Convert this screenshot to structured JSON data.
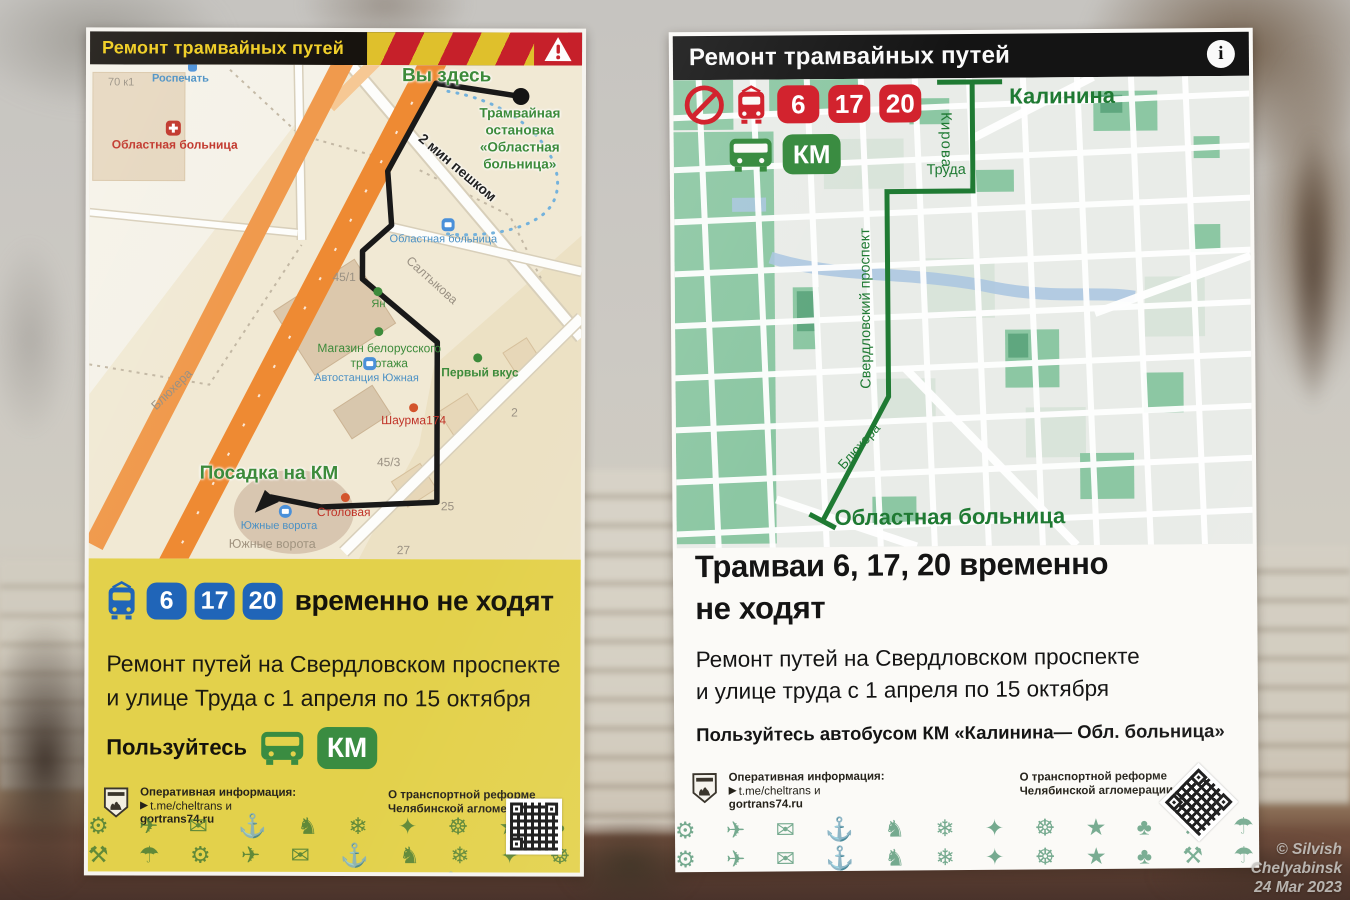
{
  "left_poster": {
    "header_title": "Ремонт трамвайных путей",
    "map": {
      "bld_70k1": "70 к1",
      "rospechat": "Роспечать",
      "hospital_poi": "Областная больница",
      "you_are_here": "Вы здесь",
      "tram_stop_l1": "Трамвайная",
      "tram_stop_l2": "остановка",
      "tram_stop_l3": "«Областная",
      "tram_stop_l4": "больница»",
      "walk_time": "2 мин пешком",
      "hospital_stop": "Областная больница",
      "saltykova": "Салтыкова",
      "bld_45_1": "45/1",
      "yan": "Ян",
      "shop_l1": "Магазин белорусского",
      "shop_l2": "трикотажа",
      "bus_station": "Автостанция Южная",
      "perviy_vkus": "Первый вкус",
      "shaurma": "Шаурма174",
      "km_boarding": "Посадка на КМ",
      "stolovaya": "Столовая",
      "south_gates_stop": "Южные ворота",
      "south_gates_area": "Южные ворота",
      "bld_45_3": "45/3",
      "bld_25": "25",
      "bld_27": "27",
      "bld_2": "2",
      "blyukhera": "Блюхера"
    },
    "notice": {
      "routes": [
        "6",
        "17",
        "20"
      ],
      "headline": "временно не ходят",
      "body_l1": "Ремонт путей на Свердловском проспекте",
      "body_l2": "и улице Труда с 1 апреля по 15 октября",
      "use_label": "Пользуйтесь",
      "km": "КМ"
    }
  },
  "right_poster": {
    "header_title": "Ремонт трамвайных путей",
    "info_mark": "i",
    "routes": [
      "6",
      "17",
      "20"
    ],
    "km": "КМ",
    "map": {
      "kalinina": "Калинина",
      "kirova": "Кирова",
      "truda": "Труда",
      "sverdlovsky": "Свердловский проспект",
      "blyukhera": "Блюхера",
      "hospital": "Областная больница"
    },
    "notice": {
      "headline_l1": "Трамваи 6, 17, 20 временно",
      "headline_l2": "не ходят",
      "body_l1": "Ремонт путей на Свердловском проспекте",
      "body_l2": "и улице труда с 1 апреля по 15 октября",
      "cta": "Пользуйтесь автобусом КМ «Калинина— Обл. больница»"
    }
  },
  "poster_footer": {
    "info_l1": "Оперативная информация:",
    "info_l2": "t.me/cheltrans и",
    "info_l3": "gortrans74.ru",
    "reform_l1": "О транспортной реформе",
    "reform_l2": "Челябинской агломерации:"
  },
  "watermark": [
    "© Silvish",
    "Chelyabinsk",
    "24 Mar 2023"
  ],
  "pattern_glyphs": "⚙ ✈ ✉ ⚓ ♞ ❄ ✦ ☸ ★ ♣ ⚒ ☂",
  "colors": {
    "left_accent_yellow": "#e3d14b",
    "tram_blue": "#2065b8",
    "bus_green": "#3a8c41",
    "alert_red": "#d2232e",
    "route_green": "#1f7a33",
    "header_yellow_text": "#f0cf2a"
  }
}
